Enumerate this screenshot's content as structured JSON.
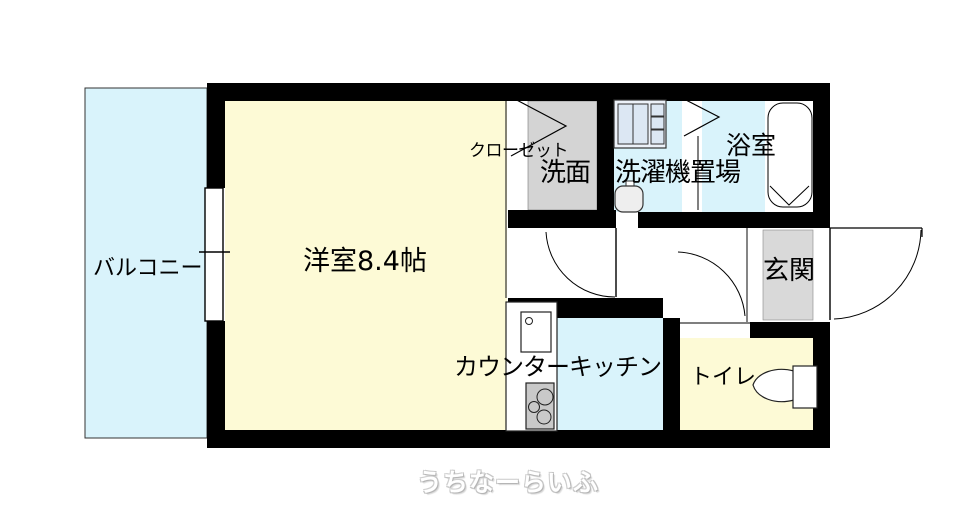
{
  "floor_plan": {
    "rooms": {
      "balcony": {
        "label": "バルコニー"
      },
      "main_room": {
        "label": "洋室8.4帖"
      },
      "closet": {
        "label": "クローゼット"
      },
      "washroom": {
        "label": "洗面・洗濯機置場"
      },
      "bathroom": {
        "label": "浴室"
      },
      "entrance": {
        "label": "玄関"
      },
      "kitchen": {
        "label": "カウンターキッチン"
      },
      "toilet": {
        "label": "トイレ"
      }
    },
    "fixtures": [
      "sliding-window",
      "closet-folding-door",
      "bathroom-folding-door",
      "washing-machine",
      "wash-basin",
      "bathtub",
      "kitchen-counter",
      "kitchen-sink",
      "gas-stove",
      "toilet-seat",
      "entrance-mat",
      "room-door",
      "hall-door",
      "entrance-door"
    ],
    "watermark": "うちなーらいふ",
    "colors": {
      "wall": "#000000",
      "water_area_floor": "#d9f3fb",
      "room_floor": "#fdfad6",
      "closet_floor": "#d4d4d4",
      "entrance_mat": "#d9d9d9",
      "stove": "#c9c9c9",
      "appliance": "#dce7f3"
    }
  }
}
